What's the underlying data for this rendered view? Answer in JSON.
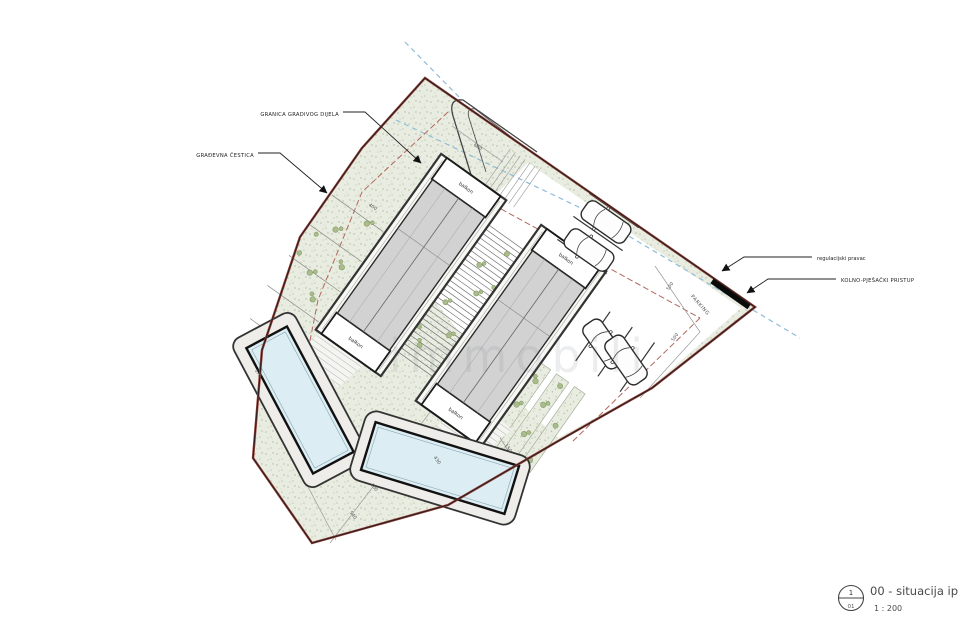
{
  "annotations": {
    "granica_gradivog_dijela": "GRANICA GRADIVOG DIJELA",
    "gradjevna_cestica": "GRAĐEVNA ČESTICA",
    "regulacijski_pravac": "regulacijski pravac",
    "kolno_pjesacki_pristup": "KOLNO-PJEŠAČKI PRISTUP",
    "parking": "PARKING",
    "balkon": "balkon"
  },
  "dimensions": [
    "400",
    "600",
    "500",
    "500",
    "170",
    "430",
    "400",
    "540",
    "150"
  ],
  "title_block": {
    "sheet_circle_top": "1",
    "sheet_circle_bottom": "01",
    "title": "00 - situacija ip",
    "scale": "1 : 200"
  },
  "watermark": "immobili",
  "colors": {
    "parcel_fill": "#e9ede1",
    "boundary_red": "#8a3b34",
    "buildable_line_red": "#b4675e",
    "regulation_blue": "#8fbcd8",
    "roof_gray": "#d2d2d2",
    "pool_water": "#dcedf3",
    "plant_green": "#a9bd8a"
  }
}
